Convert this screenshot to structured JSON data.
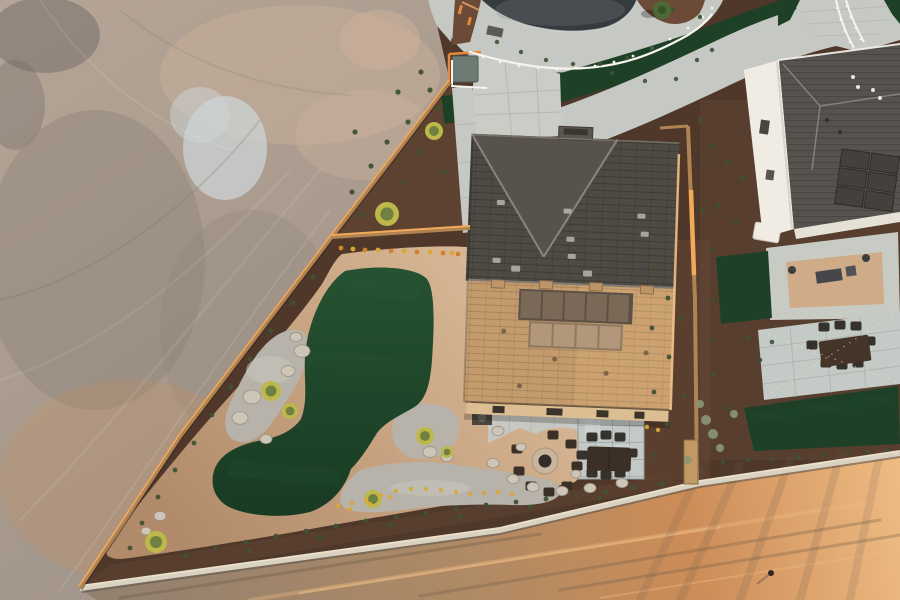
{
  "meta": {
    "title": "Aerial drone view at golden hour of a new desert-home backyard with kidney-shaped artificial turf, gravel beds, fire pit and patio, beside a graded dirt lot, cul-de-sac paths and a neighboring house"
  },
  "palette": {
    "dirt_a": "#b6a596",
    "dirt_b": "#a4978b",
    "dirt_c": "#978b7f",
    "dirt_light": "#cdb29b",
    "dirt_shadow": "#8e847a",
    "dirt_dark": "#6f6a66",
    "dirt_blue": "#ccd3d6",
    "road_base": "#93816f",
    "road_mid": "#b08a64",
    "road_orange": "#cc8c57",
    "road_bright": "#eebc83",
    "road_dark": "#6b5848",
    "mulch": "#4f382a",
    "mulch_red": "#6b4a38",
    "turf": "#1d4027",
    "turf_a": "#255231",
    "turf_b": "#193a23",
    "turf_light": "#2e5c39",
    "dg": "#c9a583",
    "dg_light": "#dcbf9d",
    "dg_dark": "#b18b69",
    "gravel": "#b7b3aa",
    "gravel_light": "#cac7bf",
    "concrete": "#c6c8c4",
    "concrete_bright": "#cbccc6",
    "concrete_shadow": "#a9aba7",
    "paver_blue": "#c2c9c7",
    "paver_joint": "#97a09e",
    "asphalt": "#363b3e",
    "asphalt_light": "#5d6468",
    "curb": "#d4d6d2",
    "roof_dark": "#4e4a44",
    "roof_dark2": "#57524b",
    "roof_ridge": "#98928a",
    "roof_tan": "#c49b6c",
    "roof_tan_bright": "#e8bc83",
    "solar_dark": "#7a6956",
    "solar_light": "#b2977a",
    "solar_frame": "#5d5045",
    "wall_tan": "#dcbe92",
    "neighbor_roof": "#56534f",
    "neighbor_wall": "#f0ece4",
    "white": "#f6f4ee",
    "fence_wood": "#b08353",
    "fence_lit": "#f2a95c",
    "block_wall": "#d9d1c1",
    "block_wall_hi": "#efe5cb",
    "block_wall_shadow": "#5f574e",
    "stone": "#cdc6b8",
    "furniture": "#3b2f26",
    "furniture_dark": "#35312b",
    "firepit_ring": "#c9b59b",
    "firepit_core": "#312c27",
    "shrub_yellow": "#bcb84a",
    "shrub_green": "#5d7040",
    "plant": "#3f5233",
    "sage": "#8a9774",
    "flower_yellow": "#d9a63c",
    "flower_orange": "#d2822f",
    "safety_orange": "#e58a3a",
    "tree_green": "#4c6a36",
    "tree_core": "#34512a",
    "kiosk": "#6e7a74",
    "mat": "#5b5b55",
    "equip": "#4a463f",
    "string_light": "#ffe9c2"
  },
  "scene": {
    "ground": "graded dirt lot with tire tracks",
    "road": "sunlit dirt access road behind block wall",
    "backyard": {
      "lawn": "kidney-shaped artificial turf",
      "path": "decomposed granite loop",
      "fire_pit_chairs": 8,
      "dining_chairs": 8,
      "gravel_beds": 3,
      "boulders": 19
    },
    "main_house": {
      "roof": "tan and dark shingle hip roof",
      "solar_panels": 9
    },
    "neighbor_house": {
      "walls": "white stucco",
      "roof": "gray shingle",
      "solar_panels": 6
    },
    "streetscape": {
      "road": "cul-de-sac asphalt",
      "paths": "curved concrete walking paths",
      "ribbon": "artificial turf ribbon",
      "railing": "white steel railing"
    }
  },
  "scatter": {
    "plants_front": [
      [
        398,
        92
      ],
      [
        421,
        72
      ],
      [
        408,
        122
      ],
      [
        387,
        142
      ],
      [
        371,
        166
      ],
      [
        352,
        192
      ],
      [
        362,
        215
      ],
      [
        419,
        152
      ],
      [
        438,
        108
      ],
      [
        444,
        172
      ],
      [
        355,
        132
      ],
      [
        404,
        182
      ],
      [
        430,
        90
      ]
    ],
    "plants_left": [
      [
        313,
        277
      ],
      [
        293,
        303
      ],
      [
        271,
        331
      ],
      [
        250,
        359
      ],
      [
        231,
        387
      ],
      [
        212,
        415
      ],
      [
        194,
        443
      ],
      [
        175,
        470
      ],
      [
        158,
        497
      ],
      [
        142,
        523
      ],
      [
        130,
        548
      ]
    ],
    "plants_bottom": [
      [
        186,
        555
      ],
      [
        216,
        548
      ],
      [
        246,
        542
      ],
      [
        276,
        536
      ],
      [
        306,
        531
      ],
      [
        336,
        526
      ],
      [
        366,
        521
      ],
      [
        396,
        517
      ],
      [
        426,
        513
      ],
      [
        456,
        509
      ],
      [
        486,
        505
      ],
      [
        516,
        502
      ],
      [
        546,
        499
      ],
      [
        576,
        496
      ],
      [
        606,
        492
      ],
      [
        634,
        488
      ],
      [
        662,
        484
      ],
      [
        250,
        551
      ],
      [
        320,
        538
      ],
      [
        390,
        525
      ],
      [
        460,
        517
      ],
      [
        530,
        507
      ],
      [
        600,
        498
      ]
    ],
    "plants_right": [
      [
        655,
        268
      ],
      [
        668,
        298
      ],
      [
        652,
        328
      ],
      [
        669,
        357
      ],
      [
        654,
        392
      ],
      [
        667,
        424
      ],
      [
        653,
        455
      ],
      [
        681,
        318
      ],
      [
        684,
        396
      ],
      [
        664,
        240
      ]
    ],
    "plants_top": [
      [
        497,
        42
      ],
      [
        521,
        52
      ],
      [
        546,
        60
      ],
      [
        573,
        64
      ],
      [
        600,
        64
      ],
      [
        627,
        58
      ],
      [
        652,
        48
      ],
      [
        612,
        73
      ],
      [
        645,
        81
      ],
      [
        676,
        79
      ],
      [
        700,
        17
      ],
      [
        673,
        10
      ],
      [
        697,
        60
      ],
      [
        712,
        50
      ]
    ],
    "plants_neighbor": [
      [
        712,
        146
      ],
      [
        727,
        162
      ],
      [
        742,
        178
      ],
      [
        718,
        205
      ],
      [
        736,
        222
      ],
      [
        710,
        250
      ],
      [
        712,
        300
      ],
      [
        710,
        340
      ],
      [
        714,
        375
      ],
      [
        726,
        408
      ],
      [
        710,
        430
      ],
      [
        748,
        338
      ],
      [
        760,
        360
      ],
      [
        772,
        342
      ],
      [
        700,
        120
      ],
      [
        704,
        160
      ],
      [
        703,
        210
      ]
    ],
    "plants_nb_bottom": [
      [
        723,
        462
      ],
      [
        748,
        460
      ],
      [
        773,
        459
      ],
      [
        798,
        457
      ],
      [
        823,
        455
      ],
      [
        848,
        453
      ],
      [
        868,
        452
      ],
      [
        886,
        450
      ]
    ],
    "flowers_orange": [
      [
        341,
        248
      ],
      [
        365,
        250
      ],
      [
        391,
        251
      ],
      [
        417,
        252
      ],
      [
        443,
        253
      ],
      [
        458,
        254
      ]
    ],
    "flowers_yellow": [
      [
        353,
        249
      ],
      [
        378,
        250
      ],
      [
        404,
        251
      ],
      [
        430,
        252
      ],
      [
        452,
        253
      ]
    ],
    "flowers_gravel": [
      [
        338,
        506
      ],
      [
        352,
        503
      ],
      [
        366,
        500
      ],
      [
        381,
        495
      ],
      [
        396,
        491
      ],
      [
        411,
        489
      ],
      [
        426,
        489
      ],
      [
        441,
        490
      ],
      [
        456,
        492
      ],
      [
        470,
        494
      ],
      [
        484,
        493
      ],
      [
        498,
        492
      ],
      [
        512,
        494
      ],
      [
        647,
        427
      ],
      [
        658,
        430
      ],
      [
        350,
        509
      ],
      [
        370,
        504
      ],
      [
        390,
        497
      ]
    ],
    "boulders": [
      [
        302,
        351,
        8
      ],
      [
        288,
        371,
        7
      ],
      [
        252,
        397,
        9
      ],
      [
        240,
        418,
        8
      ],
      [
        296,
        337,
        6
      ],
      [
        266,
        439,
        6
      ],
      [
        430,
        452,
        7
      ],
      [
        447,
        457,
        6
      ],
      [
        498,
        431,
        6
      ],
      [
        521,
        447,
        5
      ],
      [
        493,
        463,
        6
      ],
      [
        513,
        479,
        6
      ],
      [
        533,
        487,
        6
      ],
      [
        562,
        491,
        6
      ],
      [
        590,
        488,
        6
      ],
      [
        622,
        483,
        6
      ],
      [
        160,
        516,
        6
      ],
      [
        146,
        531,
        5
      ],
      [
        576,
        474,
        5
      ]
    ],
    "shrubs": [
      [
        387,
        214,
        12
      ],
      [
        434,
        131,
        9
      ],
      [
        271,
        391,
        10
      ],
      [
        290,
        411,
        8
      ],
      [
        425,
        436,
        9
      ],
      [
        373,
        499,
        9
      ],
      [
        156,
        542,
        11
      ],
      [
        447,
        452,
        6
      ]
    ],
    "sage": [
      [
        706,
        420,
        5
      ],
      [
        713,
        434,
        5
      ],
      [
        720,
        448,
        4
      ],
      [
        734,
        414,
        4
      ],
      [
        700,
        404,
        4
      ],
      [
        688,
        460,
        4
      ]
    ],
    "rail_posts": [
      [
        470,
        52
      ],
      [
        483,
        57
      ],
      [
        500,
        62
      ],
      [
        519,
        66
      ],
      [
        538,
        68
      ],
      [
        557,
        69
      ],
      [
        576,
        68
      ],
      [
        595,
        66
      ],
      [
        614,
        62
      ],
      [
        633,
        56
      ],
      [
        652,
        48
      ],
      [
        670,
        39
      ],
      [
        688,
        28
      ],
      [
        703,
        17
      ],
      [
        712,
        8
      ]
    ],
    "ramp_posts": [
      [
        837,
        8
      ],
      [
        841,
        20
      ],
      [
        845,
        31
      ],
      [
        850,
        42
      ],
      [
        855,
        50
      ],
      [
        847,
        6
      ],
      [
        851,
        17
      ],
      [
        856,
        28
      ],
      [
        861,
        39
      ]
    ],
    "fire_chairs": [
      [
        517,
        449
      ],
      [
        519,
        471
      ],
      [
        531,
        486
      ],
      [
        549,
        492
      ],
      [
        567,
        486
      ],
      [
        577,
        466
      ],
      [
        571,
        444
      ],
      [
        553,
        435
      ]
    ],
    "dining_chairs": [
      [
        592,
        437
      ],
      [
        606,
        435
      ],
      [
        620,
        437
      ],
      [
        592,
        473
      ],
      [
        606,
        475
      ],
      [
        620,
        473
      ],
      [
        582,
        455
      ],
      [
        632,
        453
      ]
    ],
    "nb_dining_chairs": [
      [
        824,
        327
      ],
      [
        840,
        325
      ],
      [
        856,
        326
      ],
      [
        826,
        363
      ],
      [
        842,
        365
      ],
      [
        858,
        363
      ],
      [
        812,
        345
      ],
      [
        870,
        341
      ]
    ]
  }
}
